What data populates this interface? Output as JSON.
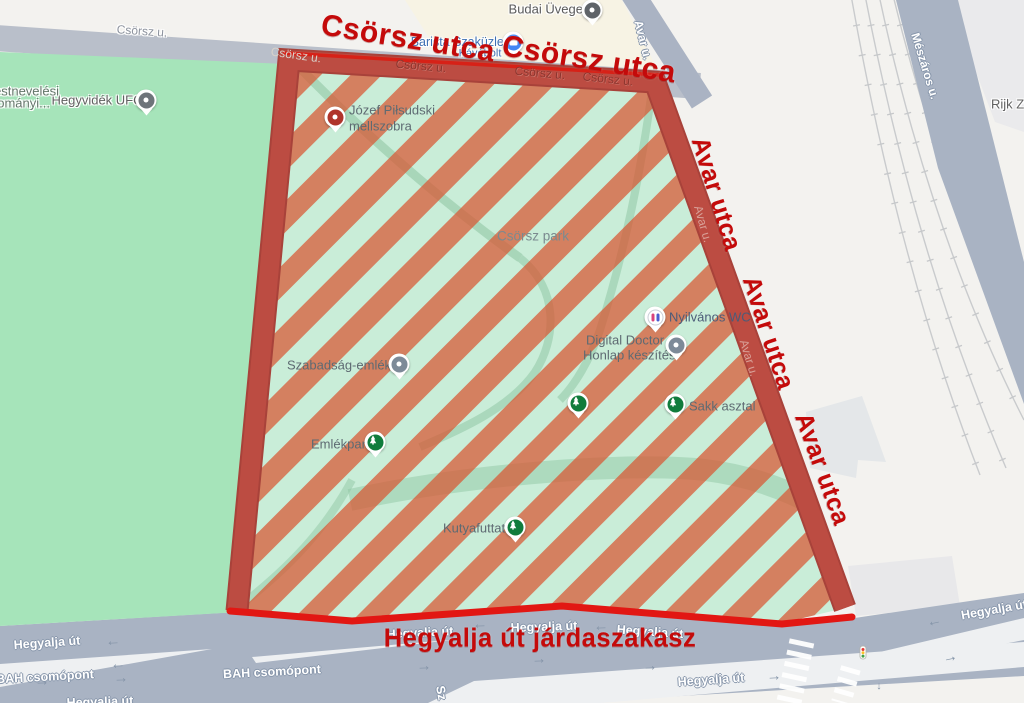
{
  "annotations": {
    "csorsz_1": "Csörsz utca",
    "csorsz_2": "Csörsz utca",
    "avar_1": "Avar utca",
    "avar_2": "Avar utca",
    "avar_3": "Avar utca",
    "hegyalja": "Hegyalja út járdaszakasz",
    "color": "#c40a0a"
  },
  "streets": {
    "csorsz_abbr": "Csörsz u.",
    "avar_abbr": "Avar u.",
    "meszaros_abbr": "Mészáros u.",
    "hegyalja": "Hegyalja út",
    "bah": "BAH csomópont",
    "sz_partial": "Sz"
  },
  "pois": {
    "budai_uveges": "Budai Üveges",
    "barista_1": "Barista Szaküzlet",
    "barista_2": "Kávébolt",
    "hegyvidek_ufc": "Hegyvidék UFC",
    "truncated_1": "estnevelési",
    "truncated_2": "dományi...",
    "pilsudski_1": "Józef Piłsudski",
    "pilsudski_2": "mellszobra",
    "csorsz_park": "Csörsz park",
    "nyilvanos_wc": "Nyilvános WC",
    "digital_doctor_1": "Digital Doctor",
    "digital_doctor_2": "Honlap készítés",
    "sakk_asztal": "Sakk asztal",
    "szabadsag": "Szabadság-emlékmű",
    "emlekpark": "Emlékpark",
    "kutyafuttato": "Kutyafuttató",
    "rijk": "Rijk Zw"
  },
  "arrows": {
    "left": "←",
    "right": "→",
    "down": "↓"
  },
  "colors": {
    "park_border": "#b7473e",
    "park_border_bright": "#e21713",
    "hatch_stripe": "#d95834",
    "park_fill": "#c9edd8",
    "field_green": "#a6e4ba",
    "road": "#a9b3c3",
    "annotation_red": "#c40a0a"
  }
}
